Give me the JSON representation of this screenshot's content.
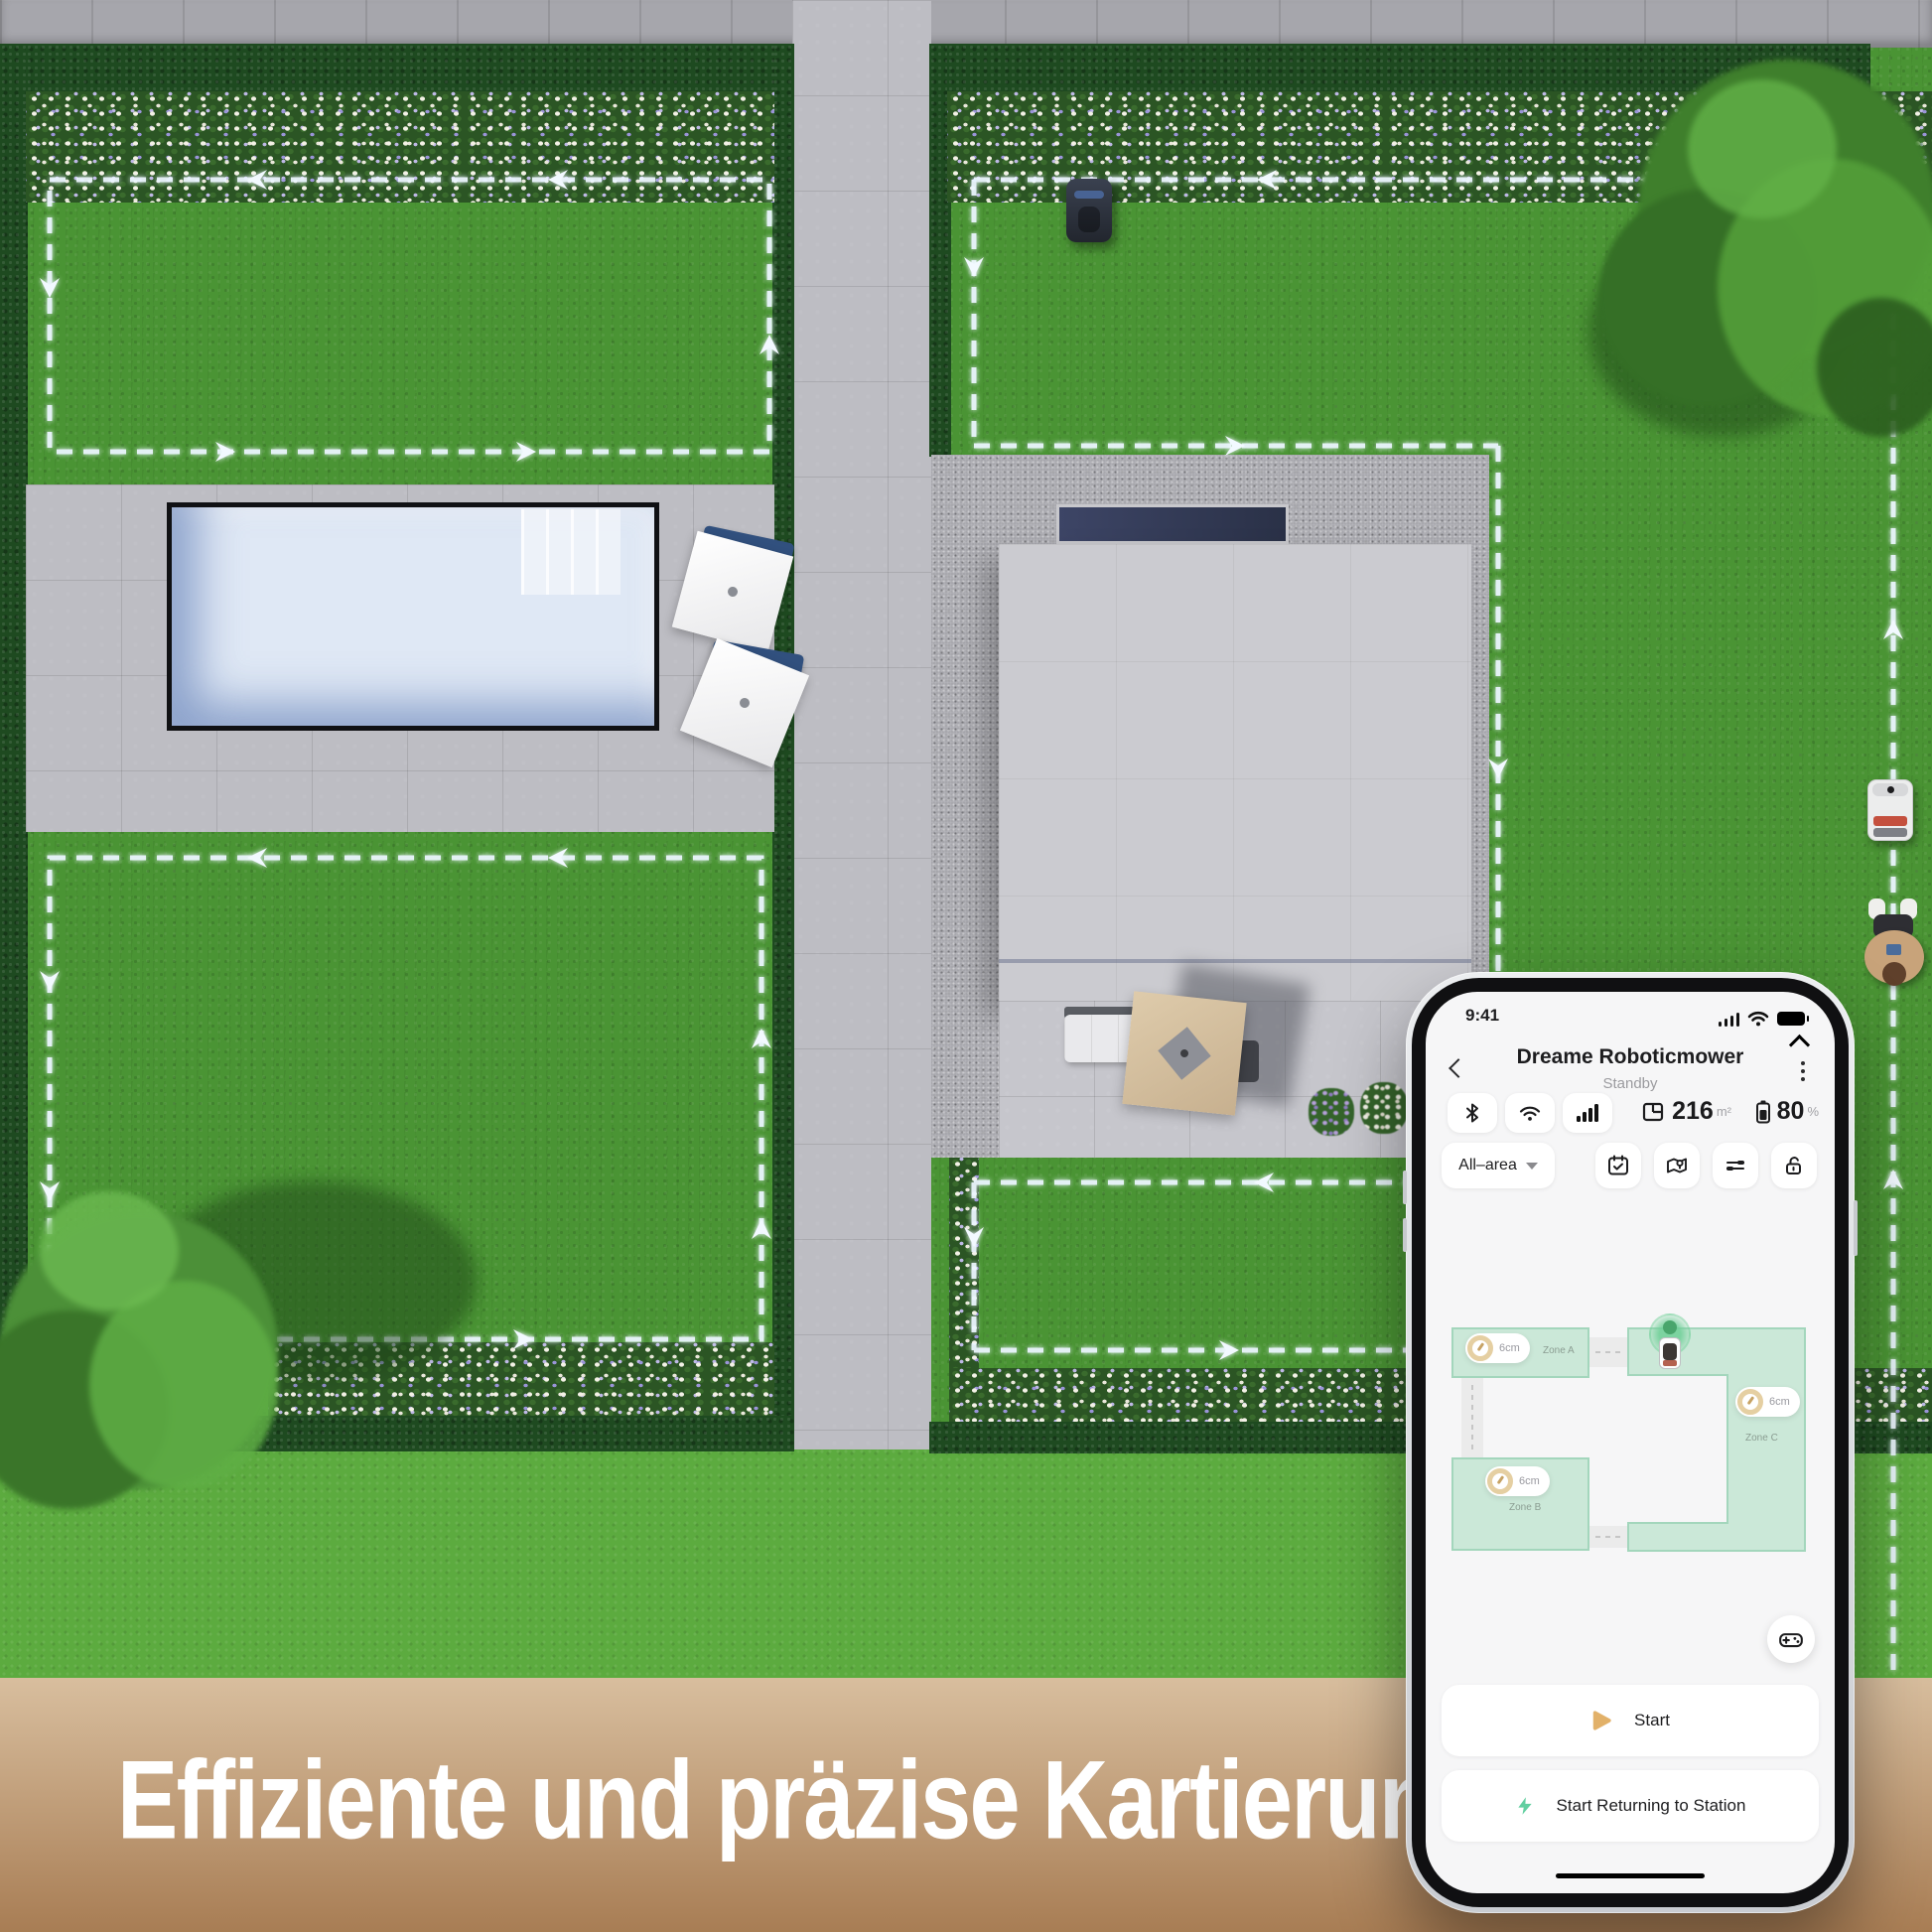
{
  "banner": {
    "title": "Effiziente und präzise Kartierung"
  },
  "phone": {
    "status_bar": {
      "time": "9:41"
    },
    "header": {
      "title": "Dreame Roboticmower",
      "subtitle": "Standby"
    },
    "stats": {
      "area_value": "216",
      "area_unit": "m²",
      "battery_value": "80",
      "battery_unit": "%"
    },
    "controls": {
      "area_selector": "All–area"
    },
    "map": {
      "zones": [
        {
          "label": "Zone A",
          "cutting_height": "6cm"
        },
        {
          "label": "Zone B",
          "cutting_height": "6cm"
        },
        {
          "label": "Zone C",
          "cutting_height": "6cm"
        }
      ]
    },
    "actions": {
      "start": "Start",
      "return_to_station": "Start Returning to Station"
    }
  },
  "theme": {
    "lawn": "#4a9434",
    "lawnLight": "#5cab3f",
    "hedge": "#1e4a20",
    "flowerGreen": "#2b5524",
    "pavers": "#bdbdc3",
    "paversDark": "#a6a6ac",
    "gravel": "#a4a4aa",
    "roof": "#cbcbd0",
    "poolWater": "#dfe8f5",
    "poolFrame": "#101114",
    "pathDash": "#ecf6ff",
    "zoneFill": "#cbe8d8",
    "zoneBorder": "#a3d6bc",
    "mint": "#62cfa0",
    "gold": "#e2b169",
    "bannerTop": "#d8be9e",
    "bannerBottom": "#a87d54",
    "screenBg": "#f6f6f7"
  }
}
